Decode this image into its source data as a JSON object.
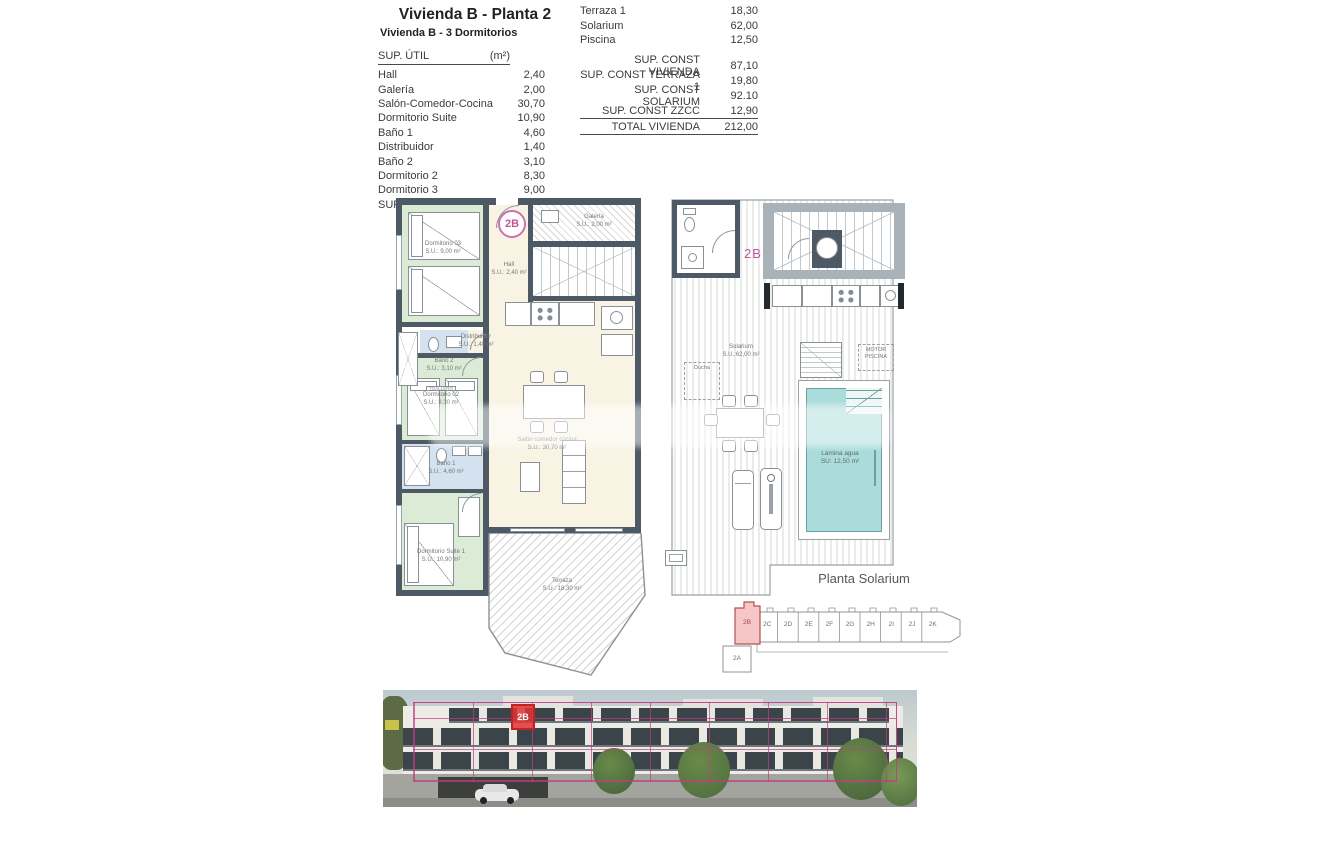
{
  "header": {
    "title": "Vivienda B - Planta 2",
    "subtitle": "Vivienda B - 3 Dormitorios"
  },
  "sup_util": {
    "header_label": "SUP. ÚTIL",
    "header_unit": "(m²)",
    "rows": [
      {
        "label": "Hall",
        "value": "2,40"
      },
      {
        "label": "Galería",
        "value": "2,00"
      },
      {
        "label": "Salón-Comedor-Cocina",
        "value": "30,70"
      },
      {
        "label": "Dormitorio Suite",
        "value": "10,90"
      },
      {
        "label": "Baño 1",
        "value": "4,60"
      },
      {
        "label": "Distribuidor",
        "value": "1,40"
      },
      {
        "label": "Baño 2",
        "value": "3,10"
      },
      {
        "label": "Dormitorio 2",
        "value": "8,30"
      },
      {
        "label": "Dormitorio 3",
        "value": "9,00"
      }
    ],
    "total": {
      "label": "SUP. ÚTIL INTERIOR",
      "value": "72,40"
    }
  },
  "exterior_areas": {
    "rows": [
      {
        "label": "Terraza 1",
        "value": "18,30"
      },
      {
        "label": "Solarium",
        "value": "62,00"
      },
      {
        "label": "Piscina",
        "value": "12,50"
      }
    ]
  },
  "const_table": {
    "rows": [
      {
        "label": "SUP. CONST VIVIENDA",
        "value": "87,10"
      },
      {
        "label": "SUP. CONST TERRAZA 1",
        "value": "19,80"
      },
      {
        "label": "SUP. CONST SOLARIUM",
        "value": "92.10"
      },
      {
        "label": "SUP. CONST ZZCC",
        "value": "12,90"
      }
    ],
    "total": {
      "label": "TOTAL VIVIENDA",
      "value": "212,00"
    }
  },
  "floor_plan": {
    "unit_badge": "2B",
    "rooms": {
      "dormitorio3": {
        "name": "Dormitorio 03",
        "area": "S.U.: 9,00 m²"
      },
      "hall": {
        "name": "Hall",
        "area": "S.U.: 2,40 m²"
      },
      "galeria": {
        "name": "Galería",
        "area": "S.U.: 2,00 m²"
      },
      "salon": {
        "name": "Salón comedor cocina",
        "area": "S.U.: 30,70 m²"
      },
      "bano2": {
        "name": "Baño 2",
        "area": "S.U.: 3,10 m²"
      },
      "distribuidor": {
        "name": "Distribuidor",
        "area": "S.U.: 1,40 m²"
      },
      "dormitorio2": {
        "name": "Dormitorio 02",
        "area": "S.U.: 8,30 m²"
      },
      "bano1": {
        "name": "Baño 1",
        "area": "S.U.: 4,60 m²"
      },
      "suite": {
        "name": "Dormitorio Suite 1",
        "area": "S.U.: 10,90 m²"
      },
      "terraza": {
        "name": "Terraza",
        "area": "S.U.: 18,30 m²"
      },
      "toallero": "TOALLERO"
    }
  },
  "solarium_plan": {
    "unit_badge": "2B",
    "caption": "Planta Solarium",
    "solarium": {
      "name": "Solarium",
      "area": "S.U.:62,00 m²"
    },
    "ducha": "Ducha",
    "motor": "MOTOR PISCINA",
    "pool": {
      "name": "Lámina agua",
      "area": "SU:  12,50 m²"
    }
  },
  "key_plan": {
    "highlight": "2B",
    "neighbors": [
      "2C",
      "2D",
      "2E",
      "2F",
      "2G",
      "2H",
      "2I",
      "2J",
      "2K"
    ],
    "below": "2A"
  },
  "photo": {
    "badge": "2B"
  },
  "colors": {
    "accent_magenta": "#c0569c",
    "highlight_red": "#d23a3a",
    "wall": "#4d5a66",
    "room_green": "#dcebd6",
    "room_blue": "#d3e2ee",
    "room_beige": "#f9f3e4",
    "pool_cyan": "#a9dcdb",
    "overlay_pink": "#bf3e82"
  }
}
